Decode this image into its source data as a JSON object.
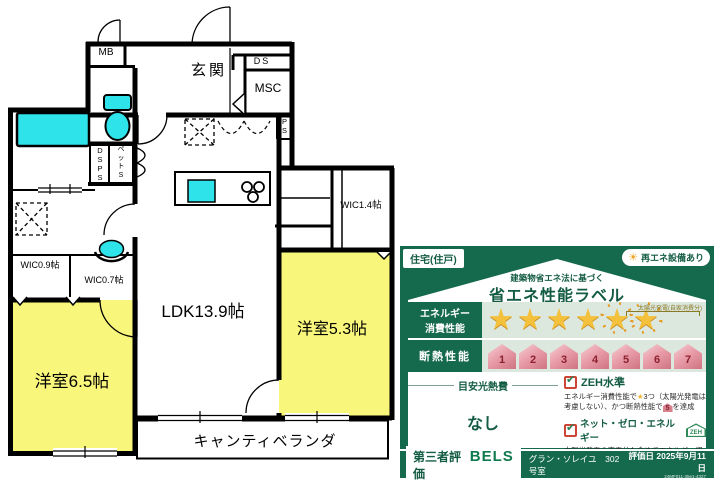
{
  "floor_plan": {
    "rooms": {
      "entrance": "玄関",
      "ldk": "LDK13.9帖",
      "bedroom_65": "洋室6.5帖",
      "bedroom_53": "洋室5.3帖",
      "wic_09": "WIC0.9帖",
      "wic_07": "WIC0.7帖",
      "wic_14": "WIC1.4帖",
      "veranda": "キャンティベランダ",
      "mb": "MB",
      "ds": "DS",
      "msc": "MSC",
      "ps": "P\nS",
      "dsps": "D\nS\nP\nS",
      "pet_s": "ペ\nッ\nト\nS"
    },
    "colors": {
      "room_yellow": "#f9f67c",
      "fixture_cyan": "#2fe3ea",
      "wall": "#000000"
    }
  },
  "energy_label": {
    "tag": "住宅(住戸)",
    "renewable_badge": "再エネ設備あり",
    "subtitle": "建築物省エネ法に基づく",
    "title": "省エネ性能ラベル",
    "rows": {
      "energy": {
        "label": "エネルギー\n消費性能",
        "stars_total": 6,
        "solar_stars": 2,
        "solar_note": "太陽光発電(自家消費分)"
      },
      "insulation": {
        "label": "断熱性能",
        "levels": [
          "1",
          "2",
          "3",
          "4",
          "5",
          "6",
          "7"
        ]
      }
    },
    "utility_cost": {
      "heading": "目安光熱費",
      "value": "なし"
    },
    "checks": [
      {
        "label": "ZEH水準",
        "desc_prefix": "エネルギー消費性能で",
        "desc_star": "★",
        "desc_mid": "3つ（太陽光発電は考慮しない）、かつ断熱性能で",
        "desc_badge": "5",
        "desc_suffix": "を達成"
      },
      {
        "label": "ネット・ゼロ・エネルギー",
        "badge": "ZEH",
        "desc": "太陽光発電の売電分も含めてエネルギー収支がゼロ以下を達成"
      }
    ],
    "footer": {
      "eval_type": "第三者評価",
      "brand": "BELS",
      "building": "グラン・ソレイユ　302号室",
      "eval_date": "評価日 2025年9月11日",
      "code": "24MF011-35e1-4327"
    },
    "colors": {
      "label_green": "#156a4e",
      "row_bg": "#dce7dd",
      "star_gold": "#f4c13d",
      "badge_pink": "#d9808d",
      "check_red": "#cc4433",
      "check_green": "#2e7d4f"
    }
  }
}
